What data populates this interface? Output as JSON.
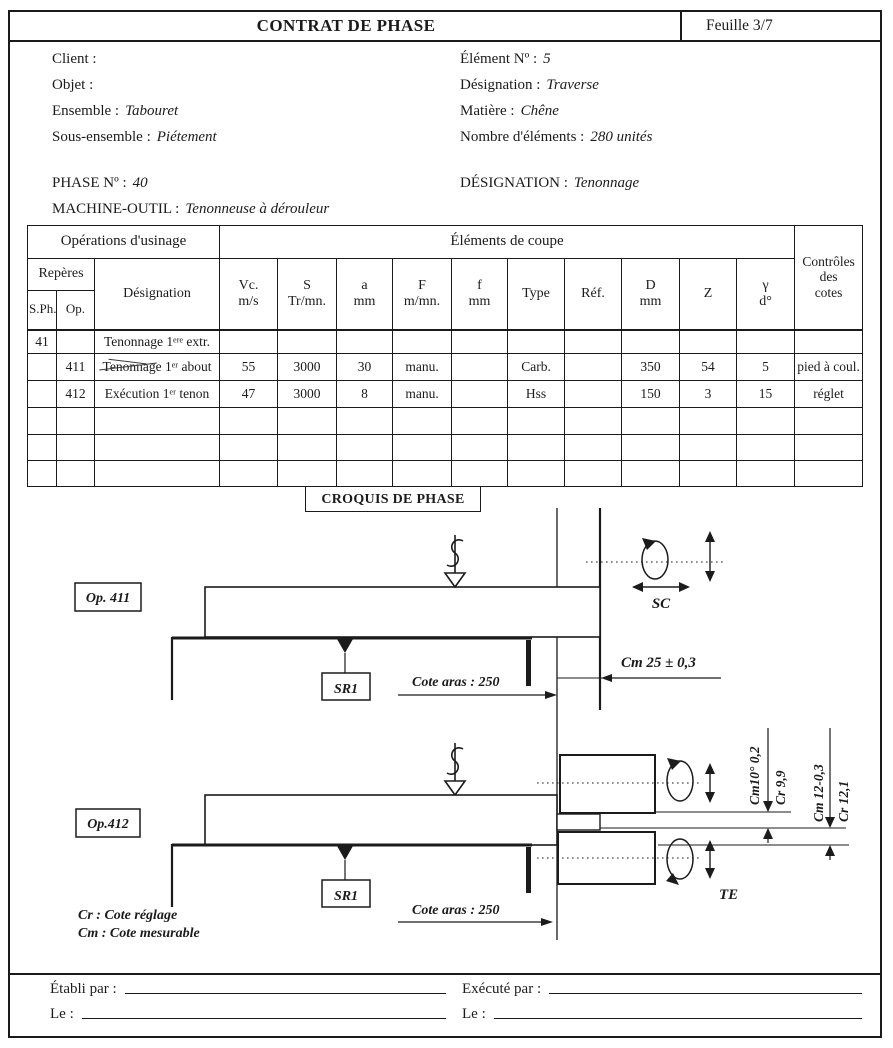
{
  "colors": {
    "ink": "#1b1b1b",
    "paper": "#ffffff"
  },
  "header": {
    "title": "CONTRAT DE PHASE",
    "sheet": "Feuille 3/7"
  },
  "info": {
    "client_label": "Client :",
    "client_value": "",
    "objet_label": "Objet :",
    "objet_value": "",
    "ensemble_label": "Ensemble :",
    "ensemble_value": "Tabouret",
    "sousensemble_label": "Sous-ensemble :",
    "sousensemble_value": "Piétement",
    "phase_label": "PHASE Nº :",
    "phase_value": "40",
    "machine_label": "MACHINE-OUTIL :",
    "machine_value": "Tenonneuse à dérouleur",
    "element_label": "Élément Nº :",
    "element_value": "5",
    "designation_label": "Désignation :",
    "designation_value": "Traverse",
    "matiere_label": "Matière :",
    "matiere_value": "Chêne",
    "nombre_label": "Nombre d'éléments :",
    "nombre_value": "280 unités",
    "phase_designation_label": "DÉSIGNATION :",
    "phase_designation_value": "Tenonnage"
  },
  "table": {
    "group": {
      "operations": "Opérations d'usinage",
      "elements": "Éléments de coupe",
      "controles": "Contrôles\ndes\ncotes"
    },
    "headers": {
      "reperes": "Repères",
      "sph": "S.Ph.",
      "op": "Op.",
      "designation": "Désignation"
    },
    "columns": [
      "Vc.\nm/s",
      "S\nTr/mn.",
      "a\nmm",
      "F\nm/mn.",
      "f\nmm",
      "Type",
      "Réf.",
      "D\nmm",
      "Z",
      "γ\nd°"
    ],
    "rows": [
      {
        "height": 24,
        "cells": [
          "41",
          "",
          "Tenonnage 1ᵉʳᵉ extr.",
          "",
          "",
          "",
          "",
          "",
          "",
          "",
          "",
          "",
          "",
          ""
        ]
      },
      {
        "height": 27,
        "strike": true,
        "cells": [
          "",
          "411",
          "Tenonnage 1ᵉʳ about",
          "55",
          "3000",
          "30",
          "manu.",
          "",
          "Carb.",
          "",
          "350",
          "54",
          "5",
          "pied à coul."
        ]
      },
      {
        "height": 27,
        "cells": [
          "",
          "412",
          "Exécution 1ᵉʳ tenon",
          "47",
          "3000",
          "8",
          "manu.",
          "",
          "Hss",
          "",
          "150",
          "3",
          "15",
          "réglet"
        ]
      },
      {
        "height": 27,
        "cells": [
          "",
          "",
          "",
          "",
          "",
          "",
          "",
          "",
          "",
          "",
          "",
          "",
          "",
          ""
        ]
      },
      {
        "height": 26,
        "cells": [
          "",
          "",
          "",
          "",
          "",
          "",
          "",
          "",
          "",
          "",
          "",
          "",
          "",
          ""
        ]
      },
      {
        "height": 26,
        "cells": [
          "",
          "",
          "",
          "",
          "",
          "",
          "",
          "",
          "",
          "",
          "",
          "",
          "",
          ""
        ]
      }
    ]
  },
  "croquis": {
    "title": "CROQUIS DE PHASE",
    "op411": {
      "label": "Op. 411",
      "sr": "SR1",
      "sc": "SC",
      "cote_aras": "Cote aras : 250",
      "cm": "Cm 25 ± 0,3"
    },
    "op412": {
      "label": "Op.412",
      "sr": "SR1",
      "te": "TE",
      "cote_aras": "Cote aras : 250",
      "dims": [
        "Cm10° 0,2",
        "Cr 9,9",
        "Cm 12-0,3",
        "Cr 12,1"
      ]
    },
    "legend": {
      "cr": "Cr : Cote réglage",
      "cm": "Cm : Cote mesurable"
    }
  },
  "footer": {
    "etabli": "Établi par :",
    "execute": "Exécuté par :",
    "le_left": "Le :",
    "le_right": "Le :"
  }
}
